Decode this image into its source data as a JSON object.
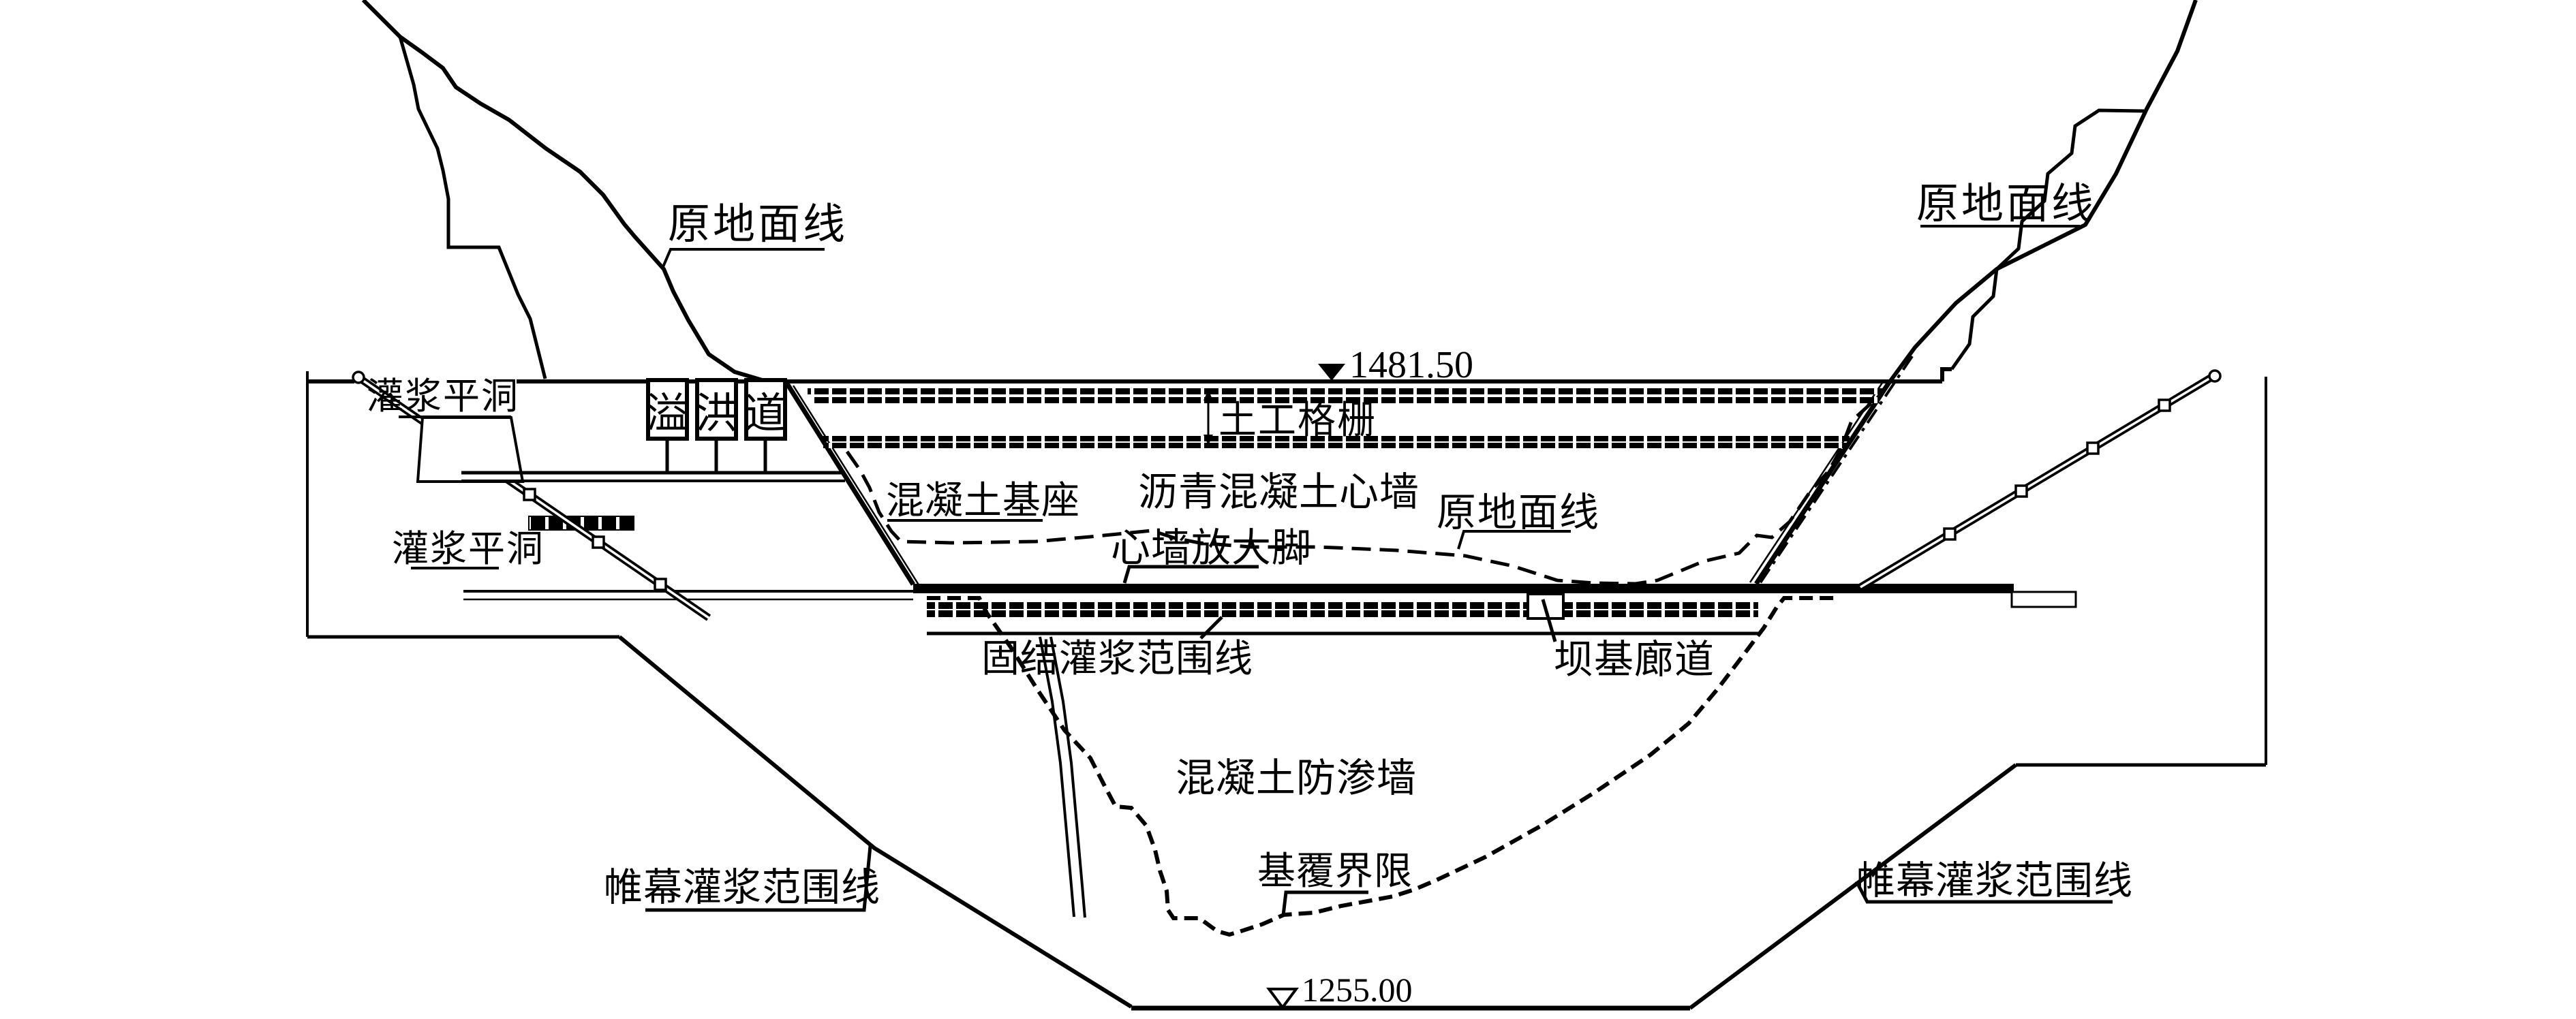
{
  "colors": {
    "ink": "#000000",
    "paper": "#ffffff"
  },
  "elevations": {
    "crest": "1481.50",
    "base": "1255.00"
  },
  "labels": {
    "original_ground_left": "原地面线",
    "original_ground_mid": "原地面线",
    "original_ground_right": "原地面线",
    "grouting_adit_upper": "灌浆平洞",
    "grouting_adit_lower": "灌浆平洞",
    "geogrid": "土工格栅",
    "concrete_base": "混凝土基座",
    "asphalt_concrete_core_wall": "沥青混凝土心墙",
    "core_wall_enlarged_foot": "心墙放大脚",
    "consolidation_grouting_range": "固结灌浆范围线",
    "dam_foundation_gallery": "坝基廊道",
    "concrete_cutoff_wall": "混凝土防渗墙",
    "bedrock_overburden_boundary": "基覆界限",
    "curtain_grouting_range_left": "帷幕灌浆范围线",
    "curtain_grouting_range_right": "帷幕灌浆范围线"
  },
  "spillway": {
    "chars": [
      "溢",
      "洪",
      "道"
    ]
  }
}
